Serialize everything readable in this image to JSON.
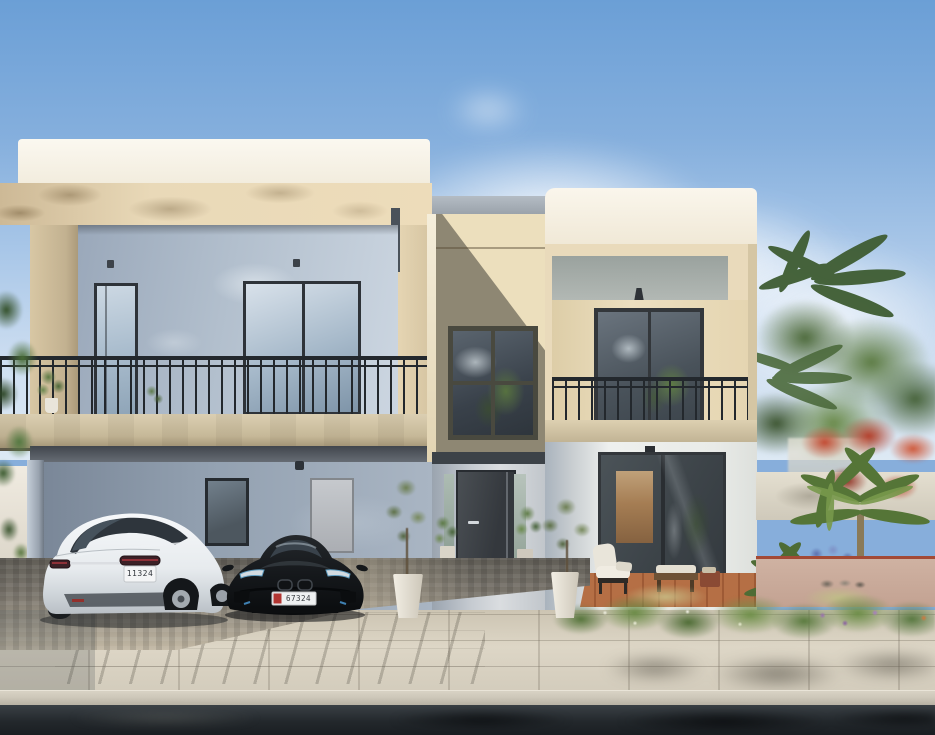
{
  "scene": {
    "description": "Sunny 3D architectural rendering of a modern two-storey cream and grey villa with covered carport, balconies with dark metal railings, a landscaped tropical garden with palms and red flowering trees, and two cars parked in the driveway.",
    "sky": {
      "top_color": "#6b9fd6",
      "horizon_color": "#dde9f4",
      "cloud_color": "#ffffff"
    },
    "villa": {
      "parapet_color": "#f7f3e8",
      "fascia_color": "#e8d8b8",
      "upper_wall_color": "#aab6c6",
      "carport_wall_color": "#8d9aab",
      "tower_sunlit_color": "#ecdfbd",
      "tower_shadow_color": "#8e8773",
      "right_wall_color": "#ecdfc0",
      "window_frame_color": "#2e3339",
      "railing_color": "#23282d",
      "balcony_slab_color": "#cfc2a6",
      "front_door_color": "#3a3e43"
    },
    "vehicles": {
      "white_sedan": {
        "label": "white luxury sedan, rear view",
        "body_color": "#eef0f2",
        "plate": "11324"
      },
      "black_sports_car": {
        "label": "black hybrid sports car, front view",
        "body_color": "#14171a",
        "plate": "67324",
        "plate_badge_color": "#b13531"
      }
    },
    "garden": {
      "foliage_color": "#5d7c44",
      "palm_color": "#5f7f3e",
      "red_flower_color": "#b4402c",
      "blue_flower_color": "#5c6fae",
      "purple_flower_color": "#9a6fb0",
      "deck_color": "#b56f45",
      "boundary_wall_color": "#e0dbcc"
    },
    "ground": {
      "sidewalk_color": "#d9d2c2",
      "cobble_color": "#7c776e",
      "pink_path_color": "#cfb2a2",
      "curb_color": "#c5bfb1",
      "road_color": "#23282c"
    }
  }
}
